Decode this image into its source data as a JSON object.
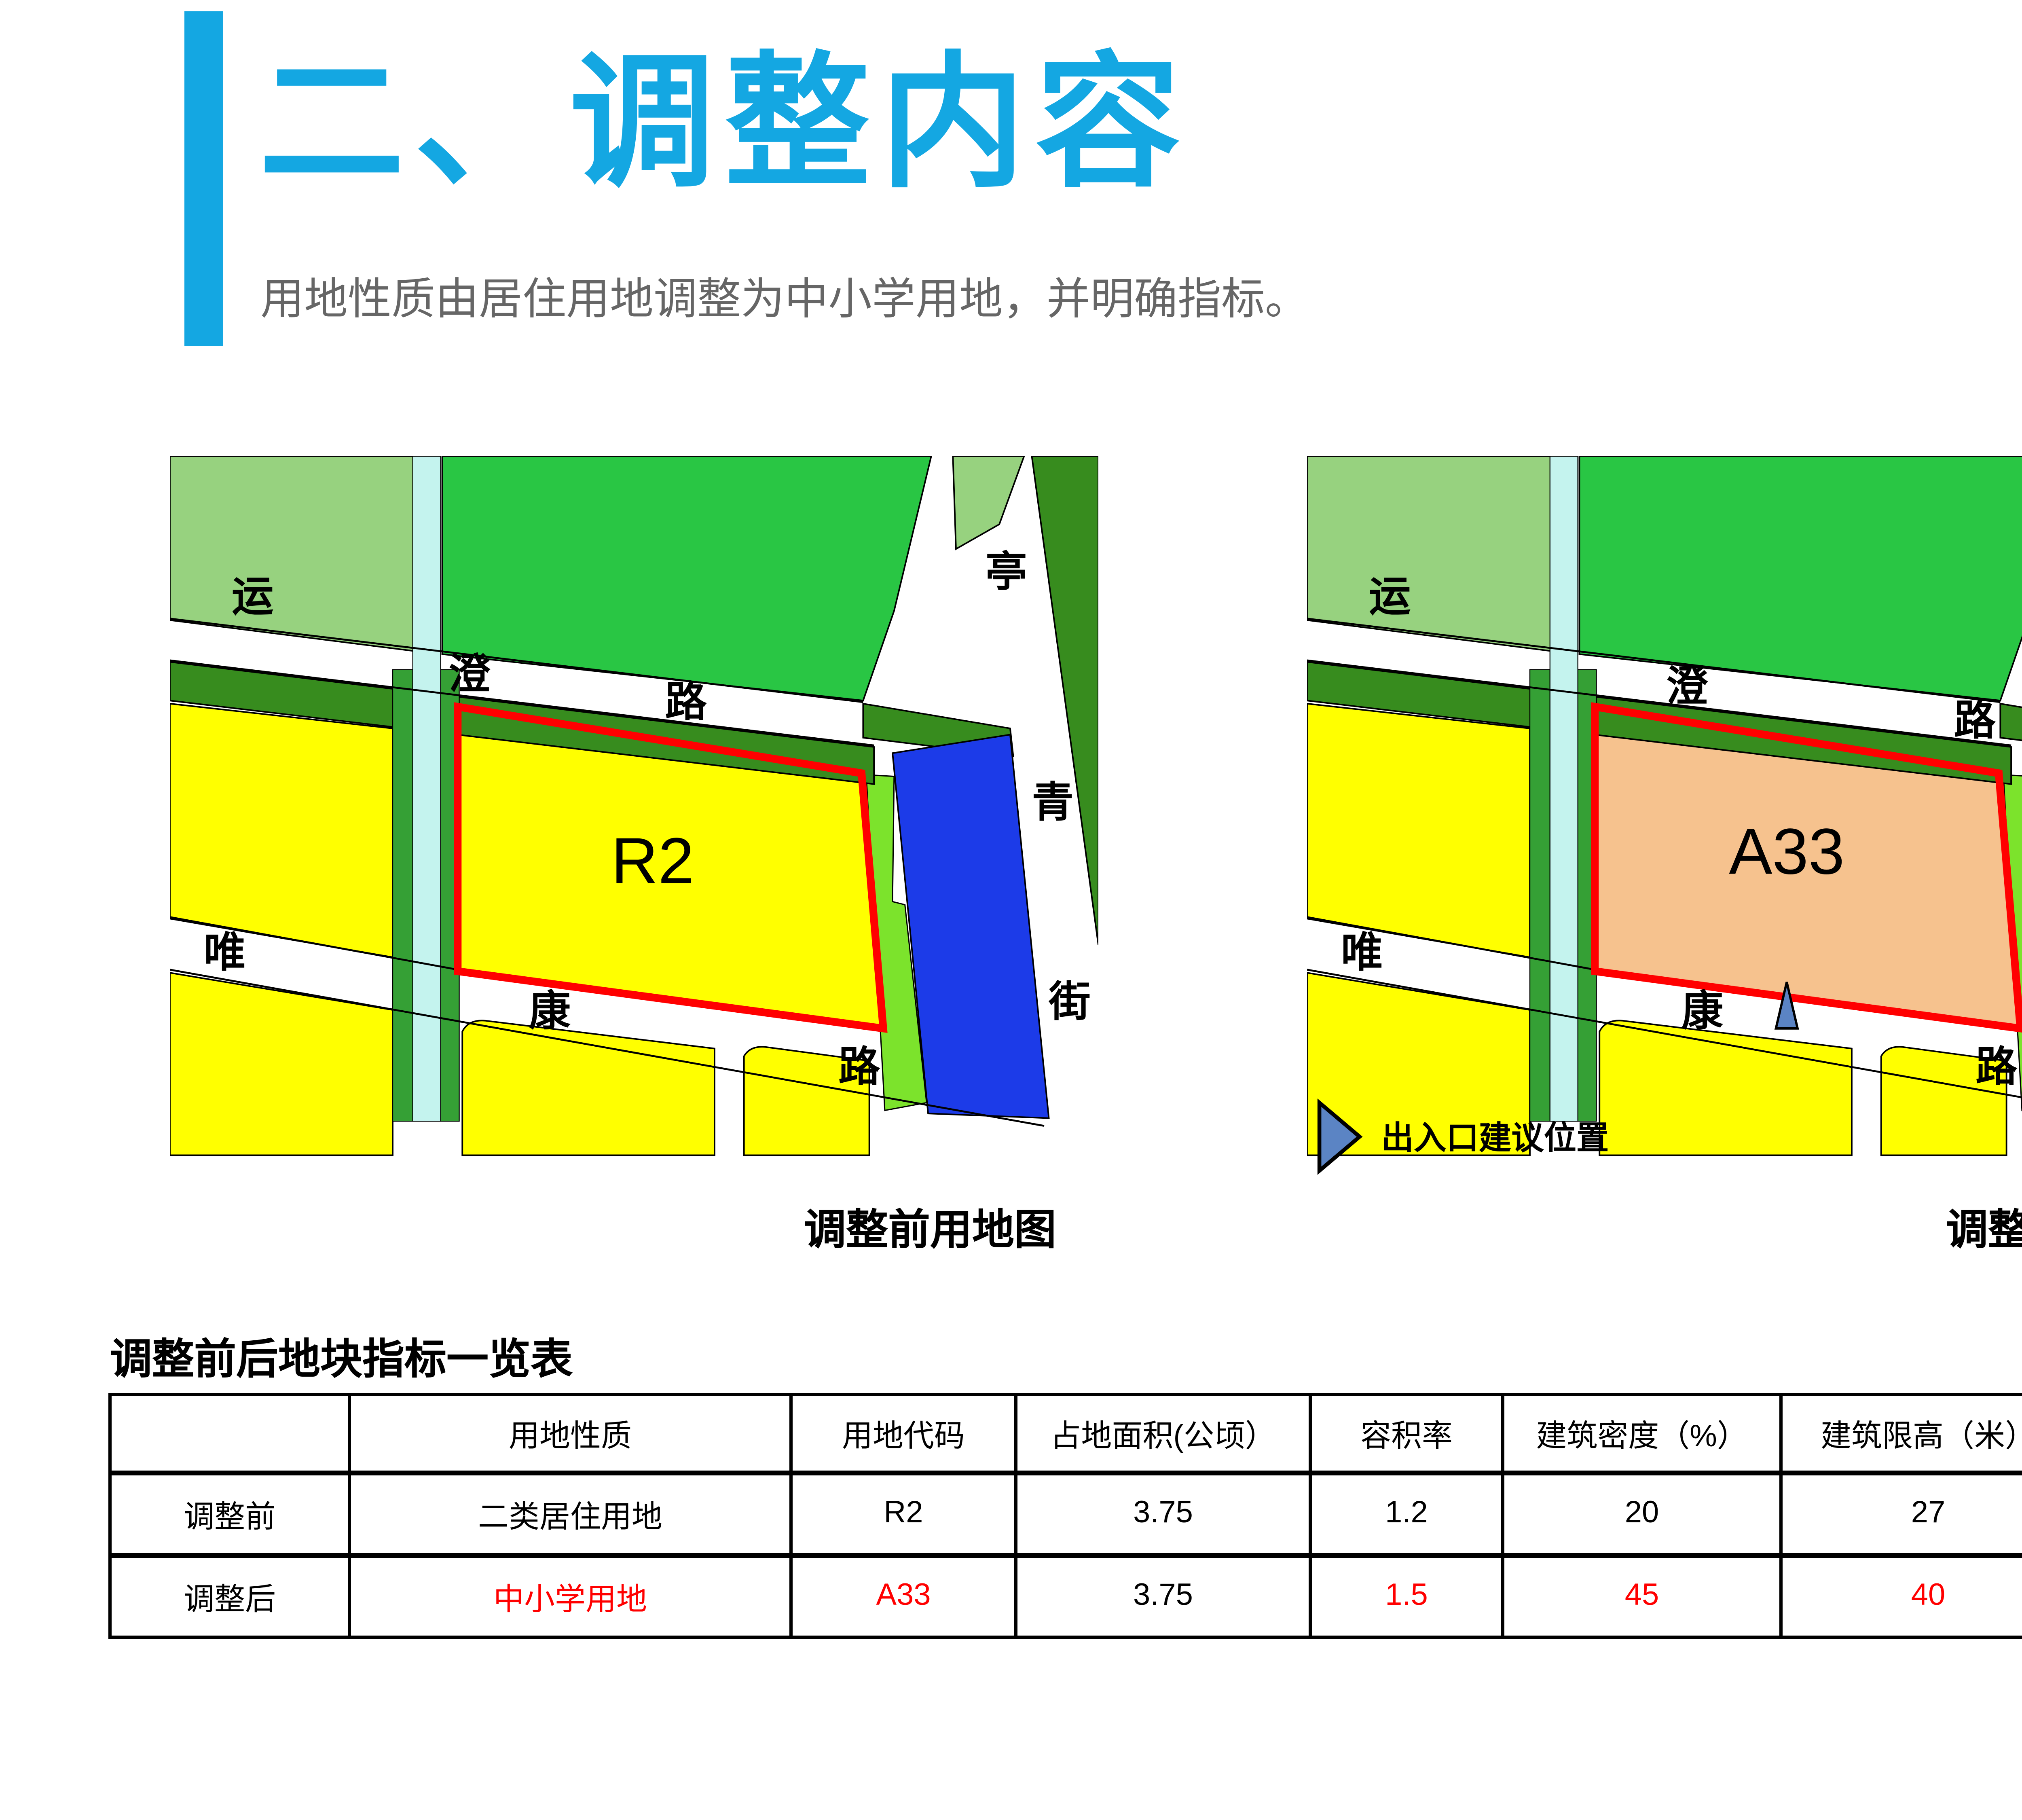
{
  "slide": {
    "title": "二、调整内容",
    "subtitle": "用地性质由居住用地调整为中小学用地，并明确指标。",
    "page_number": "16",
    "accent_color": "#14A7E2"
  },
  "maps": {
    "road_yuncheng": [
      "运",
      "澄",
      "路"
    ],
    "road_weikang": [
      "唯",
      "康",
      "路"
    ],
    "road_tingqing": [
      "亭",
      "青",
      "街"
    ],
    "before": {
      "caption": "调整前用地图",
      "parcel_code": "R2",
      "parcel_fill": "#FFFF00"
    },
    "after": {
      "caption": "调整后用地图",
      "parcel_code": "A33",
      "parcel_fill": "#F6C28E",
      "legend_label": "出入口建议位置"
    },
    "colors": {
      "light_green": "#97D27F",
      "bright_green": "#29C644",
      "dark_green": "#378C1E",
      "canal_green": "#35A035",
      "canal_cyan": "#C4F3EE",
      "yellow": "#FFFF00",
      "chartreuse": "#7CE32C",
      "blue_parcel": "#1C3BE8",
      "parcel_outline": "#FF0000",
      "marker_blue": "#5B84C4"
    }
  },
  "table": {
    "title": "调整前后地块指标一览表",
    "headers": [
      "",
      "用地性质",
      "用地代码",
      "占地面积(公顷）",
      "容积率",
      "建筑密度（%）",
      "建筑限高（米）",
      "绿化率（%）"
    ],
    "rows": [
      {
        "label": "调整前",
        "cells": [
          {
            "t": "二类居住用地"
          },
          {
            "t": "R2"
          },
          {
            "t": "3.75"
          },
          {
            "t": "1.2"
          },
          {
            "t": "20"
          },
          {
            "t": "27"
          },
          {
            "t": "40"
          }
        ]
      },
      {
        "label": "调整后",
        "cells": [
          {
            "t": "中小学用地"
          },
          {
            "t": "A33"
          },
          {
            "t": "3.75"
          },
          {
            "t": "1.5"
          },
          {
            "t": "45"
          },
          {
            "t": "40"
          },
          {
            "t": "20"
          }
        ]
      }
    ]
  }
}
